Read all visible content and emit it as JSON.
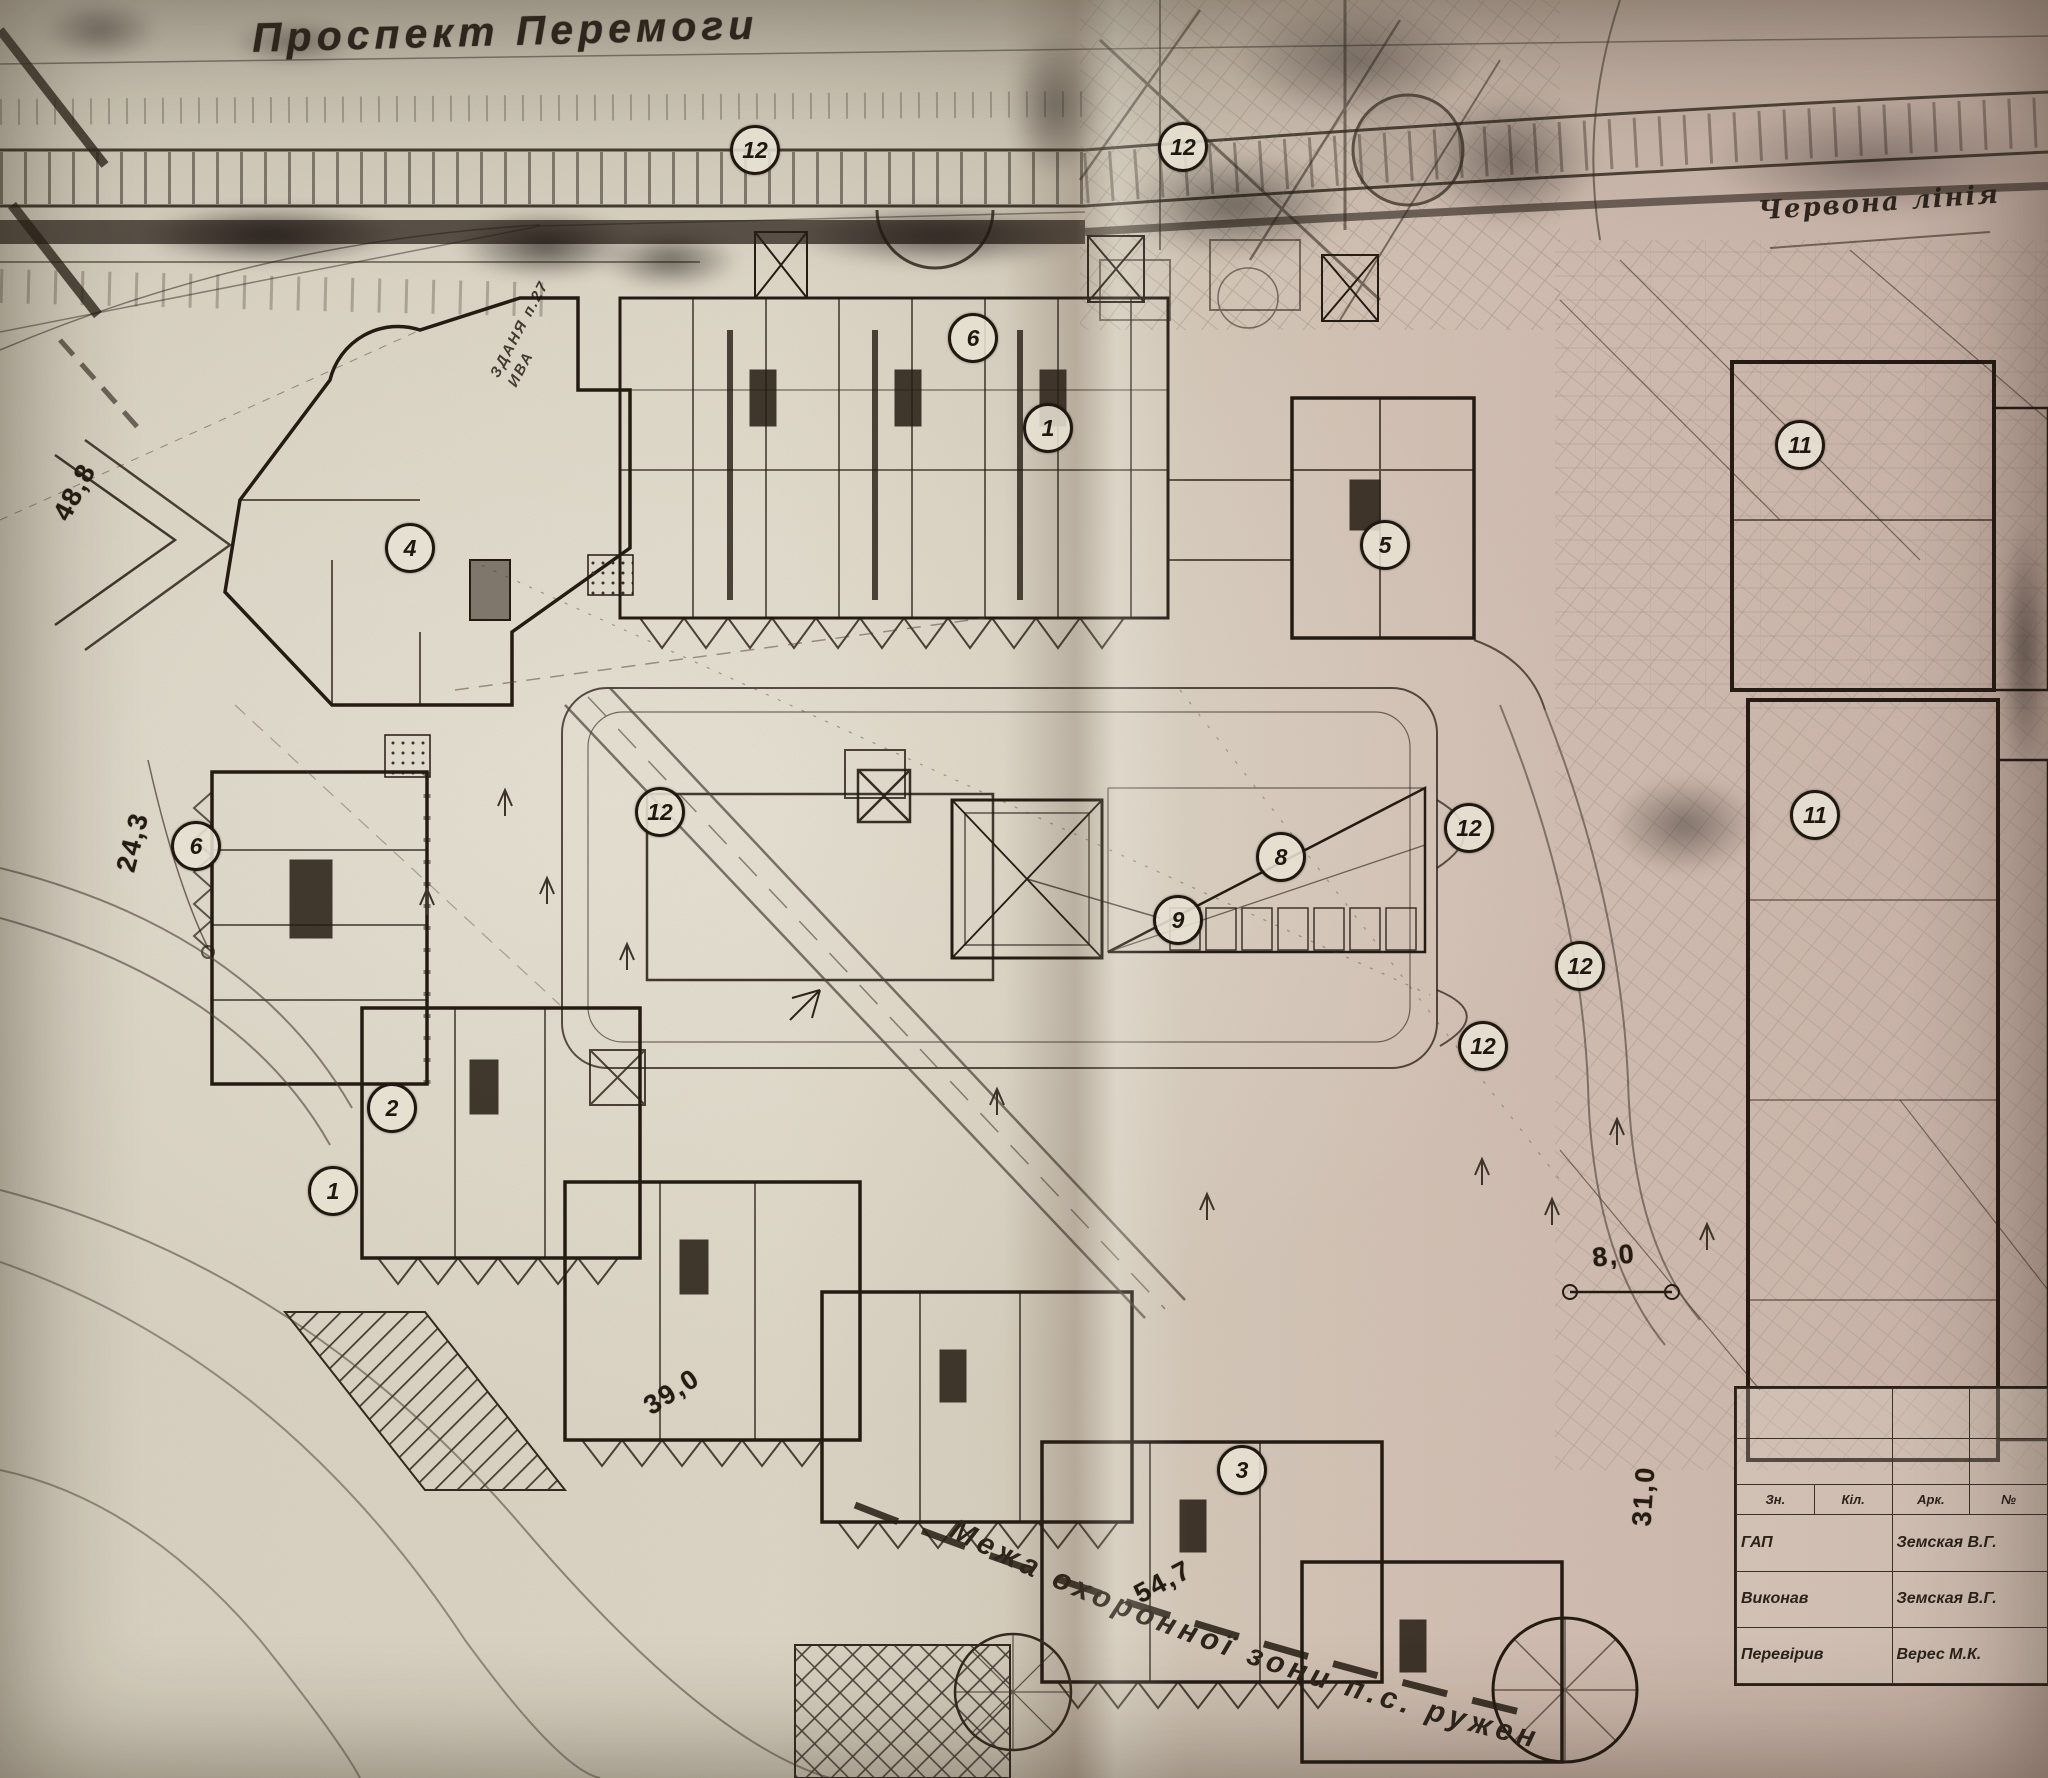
{
  "labels": {
    "street": "Проспект Перемоги",
    "red_line": "Червона лінія",
    "building_note": "ЗДАНЯ п.27\nИВА",
    "protection_zone": "Межа охоронної зони п.с. ружень"
  },
  "markers": [
    {
      "label": "12",
      "x": 755,
      "y": 150
    },
    {
      "label": "12",
      "x": 1183,
      "y": 147
    },
    {
      "label": "6",
      "x": 973,
      "y": 338
    },
    {
      "label": "1",
      "x": 1048,
      "y": 428
    },
    {
      "label": "5",
      "x": 1385,
      "y": 545
    },
    {
      "label": "11",
      "x": 1800,
      "y": 445
    },
    {
      "label": "4",
      "x": 410,
      "y": 548
    },
    {
      "label": "6",
      "x": 196,
      "y": 846
    },
    {
      "label": "12",
      "x": 660,
      "y": 812
    },
    {
      "label": "8",
      "x": 1281,
      "y": 857
    },
    {
      "label": "9",
      "x": 1178,
      "y": 920
    },
    {
      "label": "12",
      "x": 1469,
      "y": 828
    },
    {
      "label": "11",
      "x": 1815,
      "y": 815
    },
    {
      "label": "12",
      "x": 1580,
      "y": 966
    },
    {
      "label": "12",
      "x": 1483,
      "y": 1046
    },
    {
      "label": "2",
      "x": 392,
      "y": 1108
    },
    {
      "label": "1",
      "x": 333,
      "y": 1191
    },
    {
      "label": "3",
      "x": 1242,
      "y": 1470
    }
  ],
  "dimensions": [
    {
      "value": "48,8",
      "x": 75,
      "y": 492,
      "rot": -62
    },
    {
      "value": "24,3",
      "x": 133,
      "y": 842,
      "rot": -76
    },
    {
      "value": "39,0",
      "x": 672,
      "y": 1392,
      "rot": -33
    },
    {
      "value": "54,7",
      "x": 1163,
      "y": 1582,
      "rot": -28
    },
    {
      "value": "8,0",
      "x": 1614,
      "y": 1256,
      "rot": -6
    },
    {
      "value": "31,0",
      "x": 1644,
      "y": 1496,
      "rot": -86
    }
  ],
  "title_block": {
    "headers": [
      "Зн.",
      "Кіл.",
      "Арк.",
      "№"
    ],
    "rows": [
      {
        "role": "ГАП",
        "name": "Земская В.Г."
      },
      {
        "role": "Виконав",
        "name": "Земская В.Г."
      },
      {
        "role": "Перевірив",
        "name": "Верес М.К."
      }
    ]
  }
}
